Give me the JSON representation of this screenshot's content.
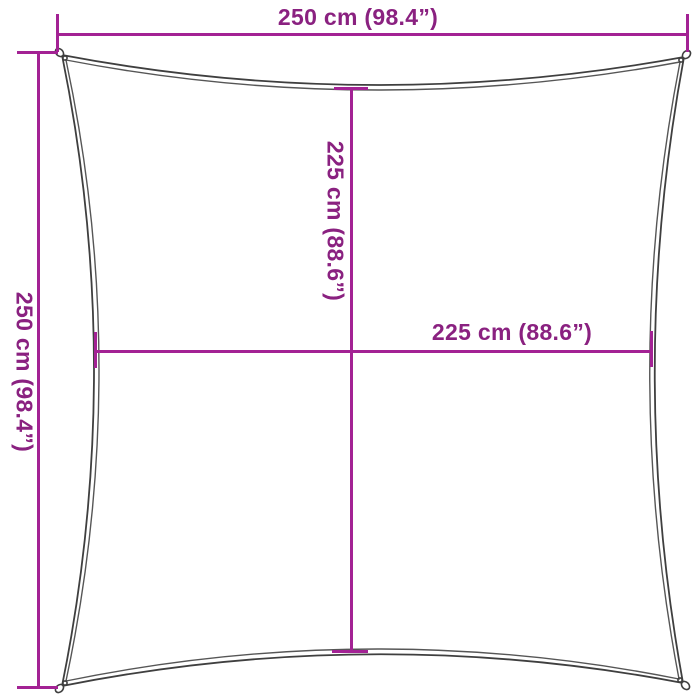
{
  "diagram": {
    "colors": {
      "dimension_line": "#a32294",
      "dimension_text": "#8a2180",
      "sail_outline": "#3f3f3f",
      "background": "#ffffff"
    },
    "dimensions": [
      {
        "id": "top-width",
        "label": "250 cm (98.4”)",
        "cm": 250,
        "inches": 98.4,
        "orientation": "horizontal"
      },
      {
        "id": "left-height",
        "label": "250 cm (98.4”)",
        "cm": 250,
        "inches": 98.4,
        "orientation": "vertical"
      },
      {
        "id": "center-height",
        "label": "225 cm (88.6”)",
        "cm": 225,
        "inches": 88.6,
        "orientation": "vertical"
      },
      {
        "id": "center-width",
        "label": "225 cm (88.6”)",
        "cm": 225,
        "inches": 88.6,
        "orientation": "horizontal"
      }
    ]
  }
}
